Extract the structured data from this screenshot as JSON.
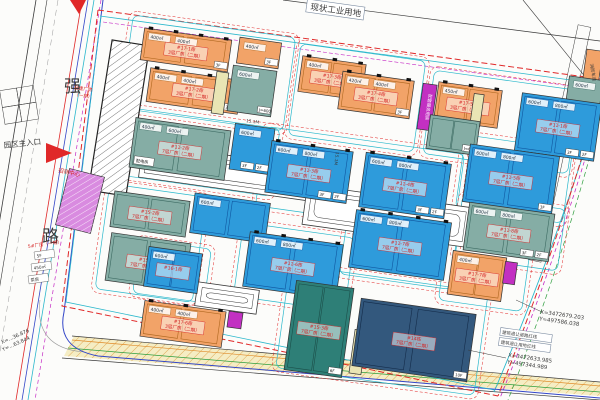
{
  "title": "产业园区规划总平面图",
  "colors": {
    "orange": "#F2A368",
    "blue": "#2E9BDB",
    "teal": "#85ADA5",
    "teal_dark": "#2E7F77",
    "navy": "#33587D",
    "magenta": "#C230C2",
    "purple": "#D98BE0",
    "beige": "#E9E5B4",
    "road_fill": "#F5EDC4",
    "red_line": "#E02828",
    "cyan_line": "#2BB8CC",
    "blue_line": "#3346C8",
    "magenta_line": "#C52BC5",
    "green_line": "#2E9E3E",
    "orange_line": "#E08A28",
    "label_red": "#D42222",
    "ink": "#3A3A3A"
  },
  "texts": {
    "parcel_top": "现状工业用地",
    "road_char1": "强",
    "road_char2": "路",
    "entrance": "园区主入口",
    "built1": "已建厂房",
    "built2": "（一期）",
    "marketing": "招商中心",
    "left_red": "5#厂房（一期）",
    "left_tags": [
      "5F",
      "450㎡",
      "泵房"
    ],
    "coord1_x": "X=3472679.203",
    "coord1_y": "Y=497586.038",
    "coord2_x": "X=3472633.985",
    "coord2_y": "Y=497344.989",
    "coord3_x": "X=…36.876",
    "coord3_y": "Y=…63.844",
    "setback1": "建筑退让道路红线",
    "setback2": "建筑退让用地红线",
    "right_tag": "消防车道",
    "street_w": "15.1M"
  },
  "plan": {
    "blocks": [
      {
        "x": 126,
        "y": 26,
        "w": 164,
        "h": 94
      },
      {
        "x": 294,
        "y": 52,
        "w": 126,
        "h": 92
      },
      {
        "x": 428,
        "y": 80,
        "w": 146,
        "h": 84
      },
      {
        "x": 124,
        "y": 118,
        "w": 152,
        "h": 68
      },
      {
        "x": 260,
        "y": 140,
        "w": 200,
        "h": 80
      },
      {
        "x": 460,
        "y": 142,
        "w": 108,
        "h": 74
      },
      {
        "x": 102,
        "y": 190,
        "w": 98,
        "h": 106
      },
      {
        "x": 238,
        "y": 230,
        "w": 112,
        "h": 74
      },
      {
        "x": 344,
        "y": 210,
        "w": 112,
        "h": 72
      },
      {
        "x": 458,
        "y": 202,
        "w": 104,
        "h": 62
      },
      {
        "x": 136,
        "y": 244,
        "w": 72,
        "h": 54
      },
      {
        "x": 282,
        "y": 278,
        "w": 200,
        "h": 104
      },
      {
        "x": 442,
        "y": 248,
        "w": 84,
        "h": 58
      }
    ],
    "strips": [
      {
        "x": 140,
        "y": 156,
        "w": 184,
        "h": 34
      },
      {
        "x": 304,
        "y": 196,
        "w": 166,
        "h": 40
      },
      {
        "x": 196,
        "y": 286,
        "w": 62,
        "h": 24
      }
    ],
    "buildings": [
      {
        "id": "built-workshop",
        "x": 100,
        "y": 42,
        "w": 38,
        "h": 152,
        "rot": 9,
        "c": "hatch"
      },
      {
        "id": "17-1",
        "x": 142,
        "y": 34,
        "w": 88,
        "h": 32,
        "c": "orange",
        "label": [
          "#17-1栋",
          "3层厂房（二期）"
        ],
        "areas": [
          "400㎡",
          "400㎡"
        ],
        "tags": [
          "3F"
        ],
        "docks": true
      },
      {
        "id": "17-1b",
        "x": 238,
        "y": 40,
        "w": 42,
        "h": 26,
        "c": "orange",
        "areas": [
          "400㎡"
        ],
        "tags": [
          "3F"
        ]
      },
      {
        "id": "17-2",
        "x": 148,
        "y": 74,
        "w": 92,
        "h": 34,
        "c": "orange",
        "label": [
          "#17-2栋",
          "3层厂房（二期）"
        ],
        "areas": [
          "400㎡",
          "400㎡"
        ],
        "tags": [
          "2F"
        ],
        "docks": true
      },
      {
        "id": "ramp-1",
        "x": 214,
        "y": 72,
        "w": 12,
        "h": 42,
        "c": "beige"
      },
      {
        "id": "teal-a",
        "x": 230,
        "y": 68,
        "w": 44,
        "h": 46,
        "c": "teal",
        "areas": [
          "600㎡"
        ],
        "tags": [
          "J=600"
        ]
      },
      {
        "id": "17-3",
        "x": 300,
        "y": 60,
        "w": 64,
        "h": 36,
        "c": "orange",
        "label": [
          "#17-3栋",
          "3层厂房（二期）"
        ],
        "areas": [
          "400㎡"
        ],
        "docks": true
      },
      {
        "id": "17-4",
        "x": 340,
        "y": 76,
        "w": 72,
        "h": 38,
        "c": "orange",
        "label": [
          "#17-4栋",
          "3层厂房（二期）"
        ],
        "areas": [
          "420㎡",
          "400㎡"
        ],
        "tags": [
          "3F"
        ],
        "docks": true
      },
      {
        "id": "service",
        "x": 420,
        "y": 84,
        "w": 14,
        "h": 46,
        "c": "magenta",
        "vtext": "配套服务用房"
      },
      {
        "id": "17-5",
        "x": 436,
        "y": 86,
        "w": 64,
        "h": 38,
        "c": "orange",
        "label": [
          "#17-5栋",
          "3层厂房（二期）"
        ],
        "areas": [
          "450㎡"
        ],
        "docks": true
      },
      {
        "id": "ramp-2",
        "x": 472,
        "y": 94,
        "w": 10,
        "h": 32,
        "c": "beige"
      },
      {
        "id": "teal-b",
        "x": 428,
        "y": 118,
        "w": 50,
        "h": 34,
        "c": "teal",
        "tags": [
          "J=600"
        ]
      },
      {
        "id": "edge-orange",
        "x": 584,
        "y": 50,
        "w": 16,
        "h": 42,
        "c": "orange"
      },
      {
        "id": "edge-teal",
        "x": 566,
        "y": 78,
        "w": 34,
        "h": 48,
        "c": "teal",
        "areas": [
          "600㎡"
        ]
      },
      {
        "id": "11-1",
        "x": 518,
        "y": 98,
        "w": 80,
        "h": 58,
        "c": "blue",
        "label": [
          "#11-1栋",
          "7层厂房（二期）"
        ],
        "areas": [
          "600㎡",
          "800㎡"
        ],
        "tags": [
          "2F",
          "3F"
        ]
      },
      {
        "id": "11-2",
        "x": 132,
        "y": 124,
        "w": 96,
        "h": 50,
        "c": "teal",
        "label": [
          "#11-2栋",
          "7层厂房（二期）"
        ],
        "areas": [
          "400㎡",
          "600㎡"
        ],
        "box": "配电房"
      },
      {
        "id": "blue-a",
        "x": 232,
        "y": 126,
        "w": 40,
        "h": 46,
        "c": "blue",
        "areas": [
          "600㎡"
        ],
        "tags": [
          "2F",
          "3F"
        ]
      },
      {
        "id": "11-3",
        "x": 268,
        "y": 146,
        "w": 82,
        "h": 52,
        "c": "blue",
        "label": [
          "#11-3栋",
          "7层厂房（二期）"
        ],
        "areas": [
          "600㎡",
          "800㎡"
        ],
        "tags": [
          "2F",
          "3F"
        ],
        "docks": true
      },
      {
        "id": "11-4",
        "x": 362,
        "y": 158,
        "w": 86,
        "h": 55,
        "c": "blue",
        "label": [
          "#11-4栋",
          "7层厂房（二期）"
        ],
        "areas": [
          "600㎡",
          "800㎡"
        ],
        "tags": [
          "2F",
          "3F"
        ],
        "docks": true
      },
      {
        "id": "11-5",
        "x": 466,
        "y": 150,
        "w": 90,
        "h": 58,
        "c": "blue",
        "label": [
          "#11-5栋",
          "7层厂房（二期）"
        ],
        "areas": [
          "600㎡",
          "800㎡"
        ],
        "tags": [
          "3F"
        ]
      },
      {
        "id": "15-2",
        "x": 112,
        "y": 196,
        "w": 76,
        "h": 36,
        "c": "teal",
        "label": [
          "#15-2栋",
          "7层厂房（二期）"
        ]
      },
      {
        "id": "15-1",
        "x": 108,
        "y": 238,
        "w": 80,
        "h": 48,
        "c": "teal",
        "label": [
          "#15-1栋",
          "7层厂房（二期）"
        ]
      },
      {
        "id": "blue-b",
        "x": 192,
        "y": 198,
        "w": 76,
        "h": 40,
        "c": "blue",
        "areas": [
          "600㎡"
        ],
        "tags": [
          "2F"
        ]
      },
      {
        "id": "11-6",
        "x": 246,
        "y": 238,
        "w": 94,
        "h": 55,
        "c": "blue",
        "label": [
          "#11-6栋",
          "7层厂房（二期）"
        ],
        "areas": [
          "600㎡",
          "800㎡"
        ],
        "tags": [
          "2F",
          "3F"
        ],
        "docks": true
      },
      {
        "id": "11-7",
        "x": 352,
        "y": 216,
        "w": 96,
        "h": 58,
        "c": "blue",
        "label": [
          "#11-7栋",
          "7层厂房（二期）"
        ],
        "areas": [
          "600㎡",
          "800㎡"
        ],
        "docks": true
      },
      {
        "id": "11-8",
        "x": 466,
        "y": 208,
        "w": 86,
        "h": 48,
        "c": "teal",
        "label": [
          "#11-8栋",
          "7层厂房（二期）"
        ],
        "areas": [
          "600㎡",
          "800㎡"
        ],
        "tags": [
          "2F",
          "3F"
        ]
      },
      {
        "id": "16-1",
        "x": 146,
        "y": 250,
        "w": 54,
        "h": 40,
        "c": "blue",
        "label": [
          "#16-1栋",
          ""
        ],
        "areas": [
          "600㎡"
        ]
      },
      {
        "id": "17-6",
        "x": 142,
        "y": 306,
        "w": 82,
        "h": 36,
        "c": "orange",
        "label": [
          "#17-6栋",
          "3层厂房（二期）"
        ],
        "areas": [
          "400㎡",
          "400㎡"
        ],
        "docks": true
      },
      {
        "id": "mag-s1",
        "x": 228,
        "y": 312,
        "w": 14,
        "h": 16,
        "c": "magenta"
      },
      {
        "id": "15-3",
        "x": 290,
        "y": 284,
        "w": 58,
        "h": 90,
        "c": "teal_dark",
        "label": [
          "#15-3栋",
          "7层厂房（二期）"
        ],
        "tags": [
          "6F"
        ]
      },
      {
        "id": "ramp-3",
        "x": 352,
        "y": 330,
        "w": 12,
        "h": 44,
        "c": "beige"
      },
      {
        "id": "14",
        "x": 356,
        "y": 306,
        "w": 116,
        "h": 68,
        "c": "navy",
        "label": [
          "#14栋",
          "7层厂房（二期）"
        ],
        "tags": [
          "10F"
        ]
      },
      {
        "id": "17-7",
        "x": 450,
        "y": 254,
        "w": 54,
        "h": 44,
        "c": "orange",
        "label": [
          "#17-7栋",
          "3层厂房（二期）"
        ],
        "areas": [
          "400㎡"
        ]
      },
      {
        "id": "mag-s2",
        "x": 504,
        "y": 262,
        "w": 12,
        "h": 22,
        "c": "magenta"
      },
      {
        "id": "marketing-center",
        "x": 62,
        "y": 172,
        "w": 36,
        "h": 58,
        "rot": 14,
        "c": "purple"
      }
    ]
  }
}
